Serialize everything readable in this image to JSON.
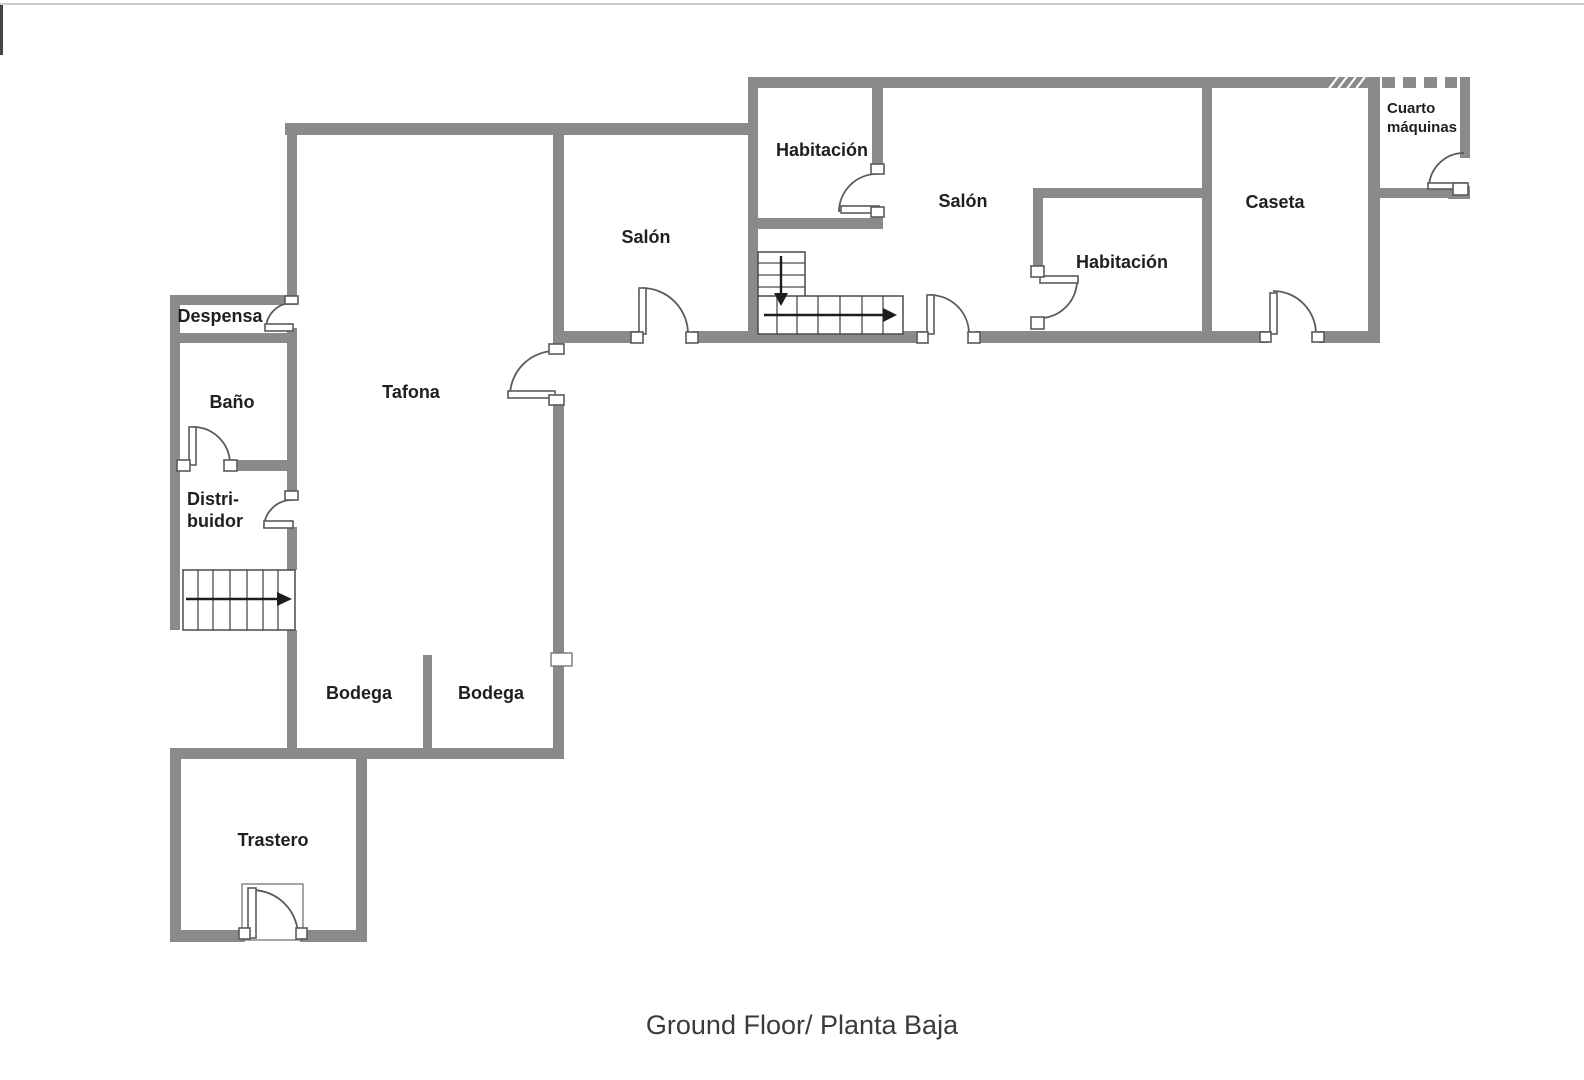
{
  "plan": {
    "caption": "Ground Floor/ Planta Baja",
    "colors": {
      "wall": "#8a8a8a",
      "door_line": "#5a5a5a",
      "label_text": "#1f1f1f",
      "caption_text": "#3b3b3b",
      "background": "#ffffff"
    },
    "rooms": {
      "despensa": {
        "label": "Despensa"
      },
      "bano": {
        "label": "Baño"
      },
      "distribuidor": {
        "line1": "Distri-",
        "line2": "buidor"
      },
      "tafona": {
        "label": "Tafona"
      },
      "bodega_left": {
        "label": "Bodega"
      },
      "bodega_right": {
        "label": "Bodega"
      },
      "trastero": {
        "label": "Trastero"
      },
      "salon_left": {
        "label": "Salón"
      },
      "habitacion_top": {
        "label": "Habitación"
      },
      "salon_right": {
        "label": "Salón"
      },
      "habitacion_right": {
        "label": "Habitación"
      },
      "caseta": {
        "label": "Caseta"
      },
      "cuarto_maquinas": {
        "line1": "Cuarto",
        "line2": "máquinas"
      }
    },
    "stairs": [
      {
        "id": "distribuidor-stairs",
        "direction": "right"
      },
      {
        "id": "corridor-stairs-down",
        "direction": "down"
      },
      {
        "id": "corridor-stairs-right",
        "direction": "right"
      }
    ]
  }
}
